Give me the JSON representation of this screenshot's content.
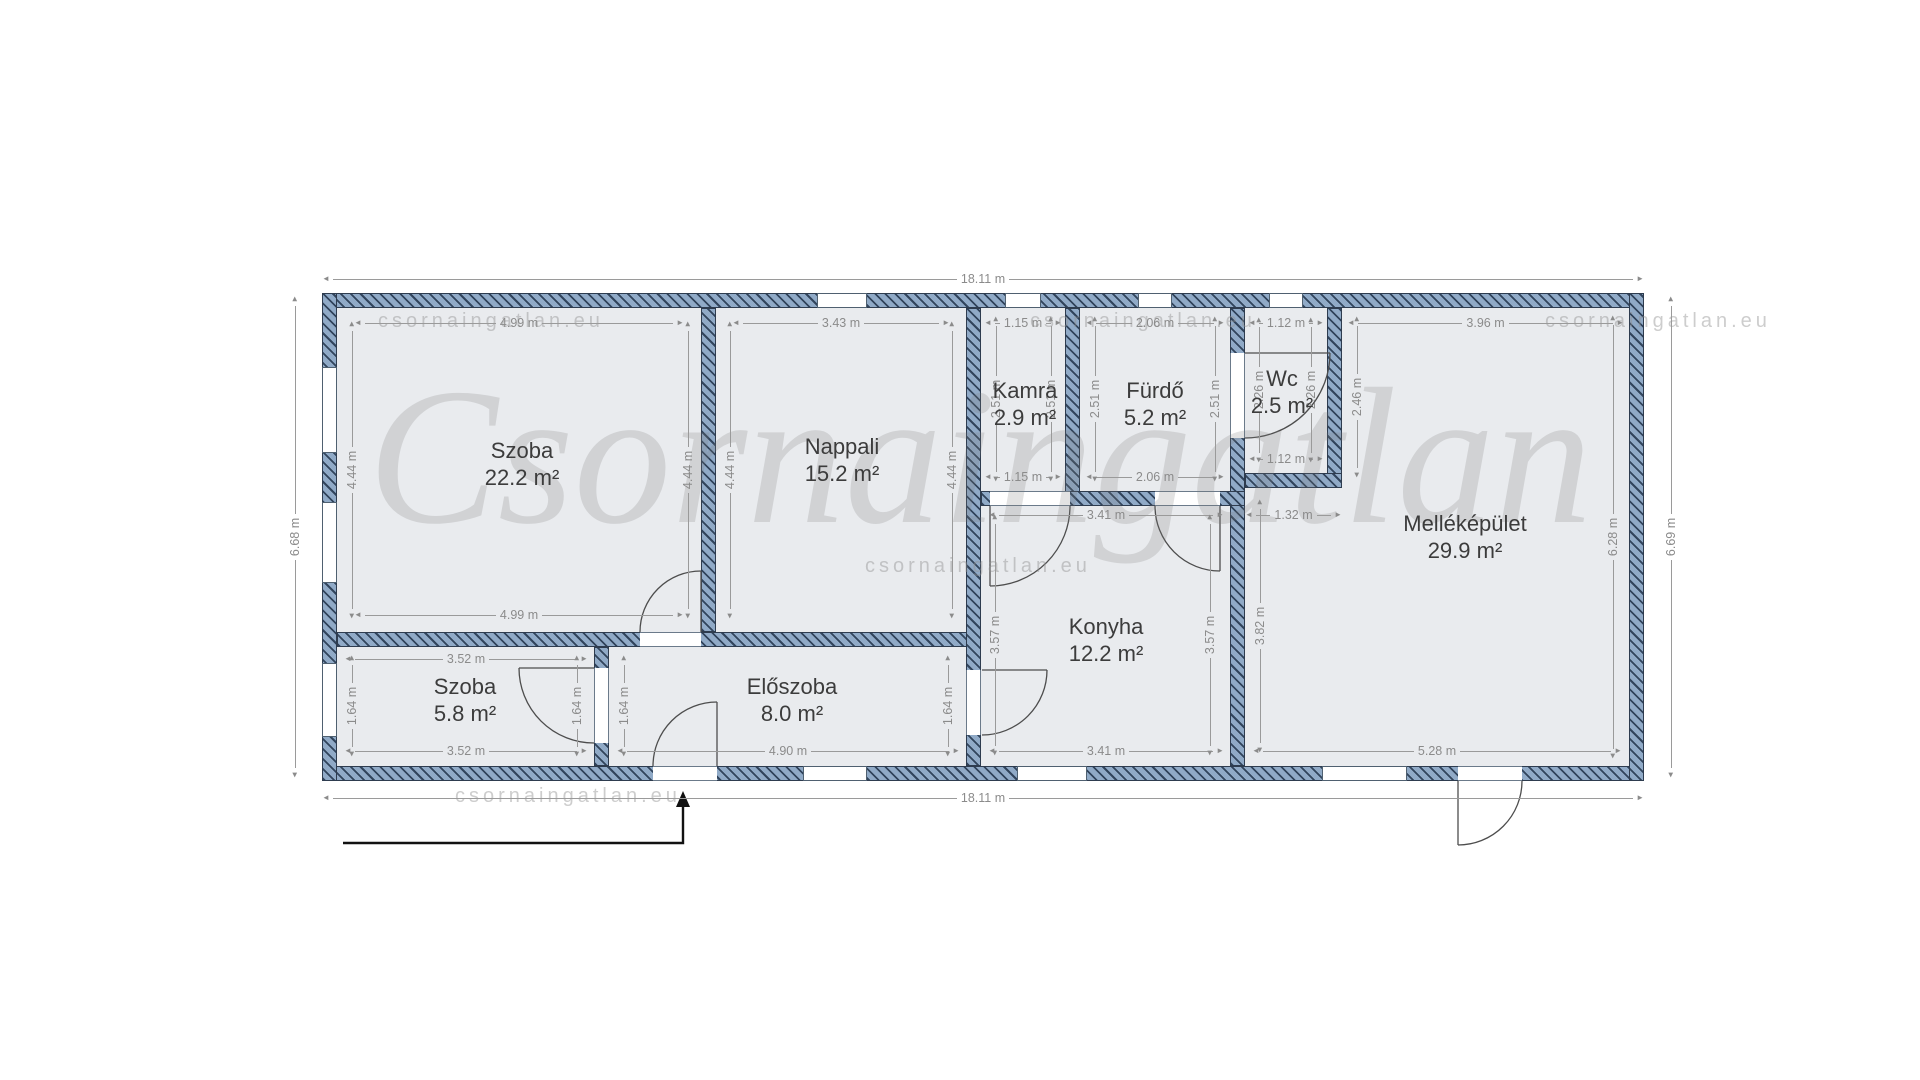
{
  "watermark": {
    "main": "Csornaingatlan",
    "small": "csornaingatlan.eu"
  },
  "rooms": [
    {
      "name": "Szoba",
      "area": "22.2 m²"
    },
    {
      "name": "Nappali",
      "area": "15.2 m²"
    },
    {
      "name": "Kamra",
      "area": "2.9 m²"
    },
    {
      "name": "Fürdő",
      "area": "5.2 m²"
    },
    {
      "name": "Wc",
      "area": "2.5 m²"
    },
    {
      "name": "Melléképület",
      "area": "29.9 m²"
    },
    {
      "name": "Szoba",
      "area": "5.8 m²"
    },
    {
      "name": "Előszoba",
      "area": "8.0 m²"
    },
    {
      "name": "Konyha",
      "area": "12.2 m²"
    }
  ],
  "dims": {
    "total_top": "18.11 m",
    "total_bottom": "18.11 m",
    "total_left": "6.68 m",
    "total_right": "6.69 m",
    "szoba22_top": "4.99 m",
    "szoba22_bottom": "4.99 m",
    "szoba22_left": "4.44 m",
    "szoba22_right": "4.44 m",
    "nappali_top": "3.43 m",
    "nappali_left": "4.44 m",
    "nappali_right": "4.44 m",
    "kamra_top": "1.15 m",
    "kamra_bottom": "1.15 m",
    "kamra_left": "2.51 m",
    "kamra_right": "2.51 m",
    "furdo_top": "2.06 m",
    "furdo_bottom": "2.06 m",
    "furdo_left": "2.51 m",
    "furdo_right": "2.51 m",
    "wc_top": "1.12 m",
    "wc_bottom": "1.12 m",
    "wc_left": "2.26 m",
    "wc_right": "2.26 m",
    "mellek_top": "3.96 m",
    "mellek_upper_left": "2.46 m",
    "mellek_right": "6.28 m",
    "mellek_bottom": "5.28 m",
    "mellek_lower_left": "3.82 m",
    "mellek_step": "1.32 m",
    "konyha_top": "3.41 m",
    "konyha_bottom": "3.41 m",
    "konyha_left": "3.57 m",
    "konyha_right": "3.57 m",
    "szoba58_top": "3.52 m",
    "szoba58_bottom": "3.52 m",
    "szoba58_left": "1.64 m",
    "szoba58_right": "1.64 m",
    "eloszoba_left": "1.64 m",
    "eloszoba_right": "1.64 m",
    "eloszoba_bottom": "4.90 m"
  }
}
